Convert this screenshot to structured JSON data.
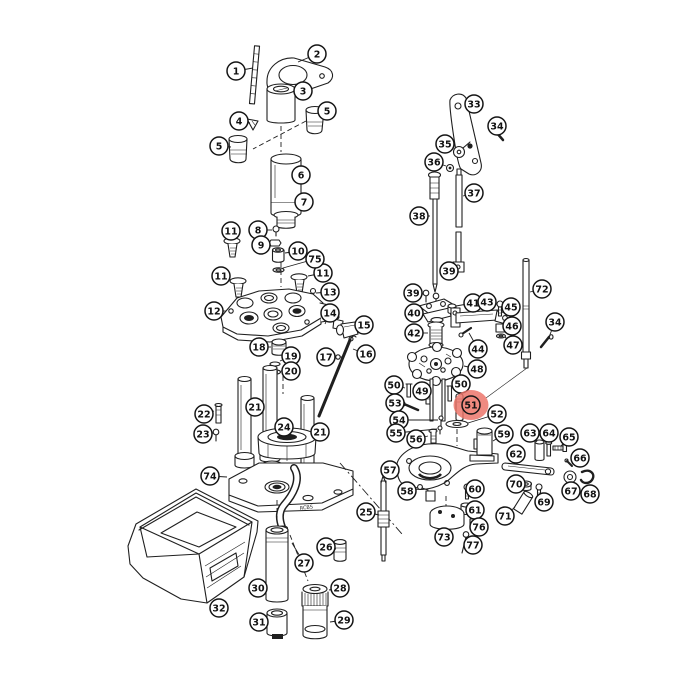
{
  "diagram": {
    "type": "exploded-parts-diagram",
    "background": "#ffffff",
    "line_color": "#1f1f1f",
    "base_marking": "RCBS",
    "callout_style": {
      "radius": 9,
      "fill": "#ffffff",
      "stroke": "#151515",
      "text_color": "#111111",
      "font_size": 9.5
    },
    "highlight": {
      "part_number": "51",
      "color": "#ec7065",
      "inner_fill": "#f0897e",
      "opacity": 0.82,
      "x": 471,
      "y": 405,
      "rx": 17.5,
      "ry": 15
    },
    "callouts": [
      {
        "n": "1",
        "x": 236,
        "y": 71,
        "tx": 253,
        "ty": 68
      },
      {
        "n": "2",
        "x": 317,
        "y": 54,
        "tx": 298,
        "ty": 62
      },
      {
        "n": "3",
        "x": 303,
        "y": 91,
        "tx": 296,
        "ty": 90
      },
      {
        "n": "4",
        "x": 239,
        "y": 121,
        "tx": 250,
        "ty": 123
      },
      {
        "n": "5",
        "x": 219,
        "y": 146,
        "tx": 231,
        "ty": 147
      },
      {
        "n": "5",
        "x": 327,
        "y": 111,
        "tx": 322,
        "ty": 114
      },
      {
        "n": "6",
        "x": 301,
        "y": 175,
        "tx": 298,
        "ty": 178
      },
      {
        "n": "7",
        "x": 304,
        "y": 202,
        "tx": 296,
        "ty": 206
      },
      {
        "n": "8",
        "x": 258,
        "y": 230,
        "tx": 272,
        "ty": 230
      },
      {
        "n": "9",
        "x": 261,
        "y": 245,
        "tx": 270,
        "ty": 243
      },
      {
        "n": "10",
        "x": 298,
        "y": 251,
        "tx": 285,
        "ty": 253
      },
      {
        "n": "11",
        "x": 231,
        "y": 231,
        "tx": 232,
        "ty": 240
      },
      {
        "n": "11",
        "x": 221,
        "y": 276,
        "tx": 231,
        "ty": 280
      },
      {
        "n": "11",
        "x": 323,
        "y": 273,
        "tx": 308,
        "ty": 276
      },
      {
        "n": "12",
        "x": 214,
        "y": 311,
        "tx": 226,
        "ty": 311
      },
      {
        "n": "13",
        "x": 330,
        "y": 292,
        "tx": 316,
        "ty": 293
      },
      {
        "n": "14",
        "x": 330,
        "y": 313,
        "tx": 325,
        "ty": 324
      },
      {
        "n": "15",
        "x": 364,
        "y": 325,
        "tx": 357,
        "ty": 328
      },
      {
        "n": "16",
        "x": 366,
        "y": 354,
        "tx": 353,
        "ty": 349
      },
      {
        "n": "17",
        "x": 326,
        "y": 357,
        "tx": 336,
        "ty": 357
      },
      {
        "n": "18",
        "x": 259,
        "y": 347,
        "tx": 271,
        "ty": 347
      },
      {
        "n": "19",
        "x": 291,
        "y": 356,
        "tx": 280,
        "ty": 361
      },
      {
        "n": "20",
        "x": 291,
        "y": 371,
        "tx": 281,
        "ty": 371
      },
      {
        "n": "21",
        "x": 255,
        "y": 407,
        "tx": 252,
        "ty": 409
      },
      {
        "n": "21",
        "x": 320,
        "y": 432,
        "tx": 315,
        "ty": 434
      },
      {
        "n": "22",
        "x": 204,
        "y": 414,
        "tx": 214,
        "ty": 411
      },
      {
        "n": "23",
        "x": 203,
        "y": 434,
        "tx": 213,
        "ty": 433
      },
      {
        "n": "24",
        "x": 284,
        "y": 427,
        "tx": 284,
        "ty": 437
      },
      {
        "n": "25",
        "x": 366,
        "y": 512,
        "tx": 379,
        "ty": 515
      },
      {
        "n": "26",
        "x": 326,
        "y": 547,
        "tx": 336,
        "ty": 549
      },
      {
        "n": "27",
        "x": 304,
        "y": 563,
        "tx": 292,
        "ty": 543
      },
      {
        "n": "28",
        "x": 340,
        "y": 588,
        "tx": 329,
        "ty": 590
      },
      {
        "n": "29",
        "x": 344,
        "y": 620,
        "tx": 330,
        "ty": 622
      },
      {
        "n": "30",
        "x": 258,
        "y": 588,
        "tx": 266,
        "ty": 589
      },
      {
        "n": "31",
        "x": 259,
        "y": 622,
        "tx": 267,
        "ty": 622
      },
      {
        "n": "32",
        "x": 219,
        "y": 608,
        "tx": 226,
        "ty": 601
      },
      {
        "n": "33",
        "x": 474,
        "y": 104,
        "tx": 468,
        "ty": 107
      },
      {
        "n": "34",
        "x": 497,
        "y": 126,
        "tx": 490,
        "ty": 131
      },
      {
        "n": "34",
        "x": 555,
        "y": 322,
        "tx": 549,
        "ty": 337
      },
      {
        "n": "35",
        "x": 445,
        "y": 144,
        "tx": 454,
        "ty": 148
      },
      {
        "n": "36",
        "x": 434,
        "y": 162,
        "tx": 446,
        "ty": 166
      },
      {
        "n": "37",
        "x": 474,
        "y": 193,
        "tx": 463,
        "ty": 196
      },
      {
        "n": "38",
        "x": 419,
        "y": 216,
        "tx": 430,
        "ty": 216
      },
      {
        "n": "39",
        "x": 449,
        "y": 271,
        "tx": 455,
        "ty": 265
      },
      {
        "n": "39",
        "x": 413,
        "y": 293,
        "tx": 423,
        "ty": 294
      },
      {
        "n": "40",
        "x": 414,
        "y": 313,
        "tx": 421,
        "ty": 311
      },
      {
        "n": "41",
        "x": 473,
        "y": 303,
        "tx": 456,
        "ty": 306
      },
      {
        "n": "42",
        "x": 414,
        "y": 333,
        "tx": 428,
        "ty": 333
      },
      {
        "n": "43",
        "x": 487,
        "y": 302,
        "tx": 486,
        "ty": 309
      },
      {
        "n": "44",
        "x": 478,
        "y": 349,
        "tx": 469,
        "ty": 333
      },
      {
        "n": "45",
        "x": 511,
        "y": 307,
        "tx": 503,
        "ty": 305
      },
      {
        "n": "46",
        "x": 512,
        "y": 326,
        "tx": 506,
        "ty": 328
      },
      {
        "n": "47",
        "x": 513,
        "y": 345,
        "tx": 505,
        "ty": 337
      },
      {
        "n": "48",
        "x": 477,
        "y": 369,
        "tx": 464,
        "ty": 366
      },
      {
        "n": "49",
        "x": 422,
        "y": 391,
        "tx": 427,
        "ty": 395
      },
      {
        "n": "50",
        "x": 394,
        "y": 385,
        "tx": 405,
        "ty": 388
      },
      {
        "n": "50",
        "x": 461,
        "y": 384,
        "tx": 452,
        "ty": 388
      },
      {
        "n": "51",
        "x": 471,
        "y": 405,
        "tx": 464,
        "ty": 404,
        "hl": true
      },
      {
        "n": "52",
        "x": 497,
        "y": 414,
        "tx": 468,
        "ty": 423
      },
      {
        "n": "53",
        "x": 395,
        "y": 403,
        "tx": 405,
        "ty": 406
      },
      {
        "n": "54",
        "x": 399,
        "y": 420,
        "tx": 438,
        "ty": 420
      },
      {
        "n": "55",
        "x": 396,
        "y": 433,
        "tx": 437,
        "ty": 429
      },
      {
        "n": "56",
        "x": 416,
        "y": 439,
        "tx": 428,
        "ty": 436
      },
      {
        "n": "57",
        "x": 390,
        "y": 470,
        "tx": 399,
        "ty": 469
      },
      {
        "n": "58",
        "x": 407,
        "y": 491,
        "tx": 418,
        "ty": 487
      },
      {
        "n": "59",
        "x": 504,
        "y": 434,
        "tx": 493,
        "ty": 441
      },
      {
        "n": "60",
        "x": 475,
        "y": 489,
        "tx": 470,
        "ty": 488
      },
      {
        "n": "61",
        "x": 475,
        "y": 510,
        "tx": 472,
        "ty": 507
      },
      {
        "n": "62",
        "x": 516,
        "y": 454,
        "tx": 517,
        "ty": 464
      },
      {
        "n": "63",
        "x": 530,
        "y": 433,
        "tx": 537,
        "ty": 442
      },
      {
        "n": "64",
        "x": 549,
        "y": 433,
        "tx": 549,
        "ty": 442
      },
      {
        "n": "65",
        "x": 569,
        "y": 437,
        "tx": 561,
        "ty": 446
      },
      {
        "n": "66",
        "x": 580,
        "y": 458,
        "tx": 572,
        "ty": 464
      },
      {
        "n": "67",
        "x": 571,
        "y": 491,
        "tx": 570,
        "ty": 484
      },
      {
        "n": "68",
        "x": 590,
        "y": 494,
        "tx": 589,
        "ty": 485
      },
      {
        "n": "69",
        "x": 544,
        "y": 502,
        "tx": 540,
        "ty": 497
      },
      {
        "n": "70",
        "x": 516,
        "y": 484,
        "tx": 521,
        "ty": 485
      },
      {
        "n": "71",
        "x": 505,
        "y": 516,
        "tx": 515,
        "ty": 507
      },
      {
        "n": "72",
        "x": 542,
        "y": 289,
        "tx": 530,
        "ty": 292
      },
      {
        "n": "73",
        "x": 444,
        "y": 537,
        "tx": 447,
        "ty": 528
      },
      {
        "n": "74",
        "x": 210,
        "y": 476,
        "tx": 227,
        "ty": 477
      },
      {
        "n": "75",
        "x": 315,
        "y": 259,
        "tx": 283,
        "ty": 268
      },
      {
        "n": "76",
        "x": 479,
        "y": 527,
        "tx": 473,
        "ty": 521
      },
      {
        "n": "77",
        "x": 473,
        "y": 545,
        "tx": 468,
        "ty": 542
      }
    ]
  }
}
